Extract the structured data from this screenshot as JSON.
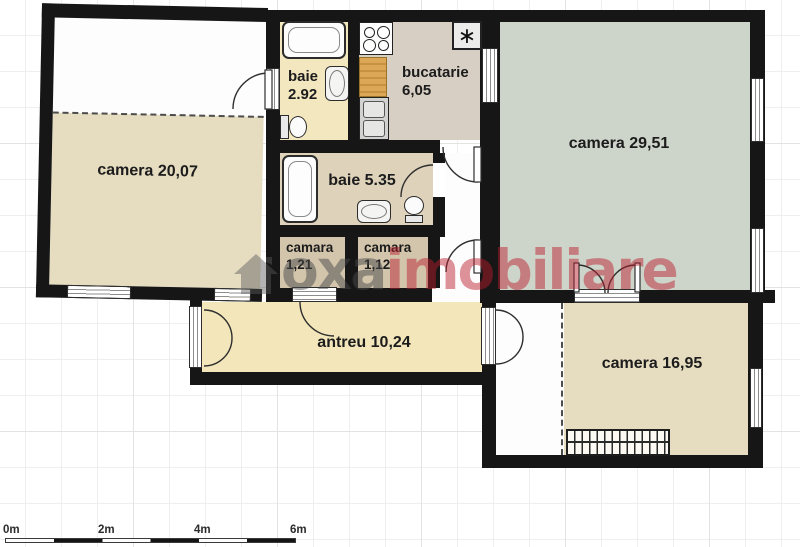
{
  "title": "apartment floor plan",
  "rooms": {
    "camera_20": {
      "label": "camera 20,07"
    },
    "baie_292": {
      "name": "baie",
      "area": "2.92"
    },
    "bucatarie": {
      "name": "bucatarie",
      "area": "6,05"
    },
    "camera_2951": {
      "label": "camera 29,51"
    },
    "baie_535": {
      "label": "baie 5.35"
    },
    "camara_121": {
      "name": "camara",
      "area": "1,21"
    },
    "camara_112": {
      "name": "camara",
      "area": "1,12"
    },
    "antreu": {
      "label": "antreu 10,24"
    },
    "camera_1695": {
      "label": "camera 16,95"
    }
  },
  "watermark": {
    "prefix": "oxa",
    "suffix": "imobiliare",
    "gray": "#484848",
    "red": "#ba1e2e"
  },
  "icons": {
    "fridge": "∗"
  },
  "scale_bar": {
    "labels": [
      "0m",
      "2m",
      "4m",
      "6m"
    ]
  },
  "colors": {
    "wall": "#161616",
    "room_beige": "#e6ddc1",
    "bath_cream": "#f3e7c0",
    "kitchen_taupe": "#d7cfc3",
    "living_green": "#cdd4c9",
    "bath_tan": "#ded2ba",
    "pantry_tan": "#d3c5ac",
    "hall_cream": "#f2e6ba",
    "wood_counter": "#dcа857"
  }
}
